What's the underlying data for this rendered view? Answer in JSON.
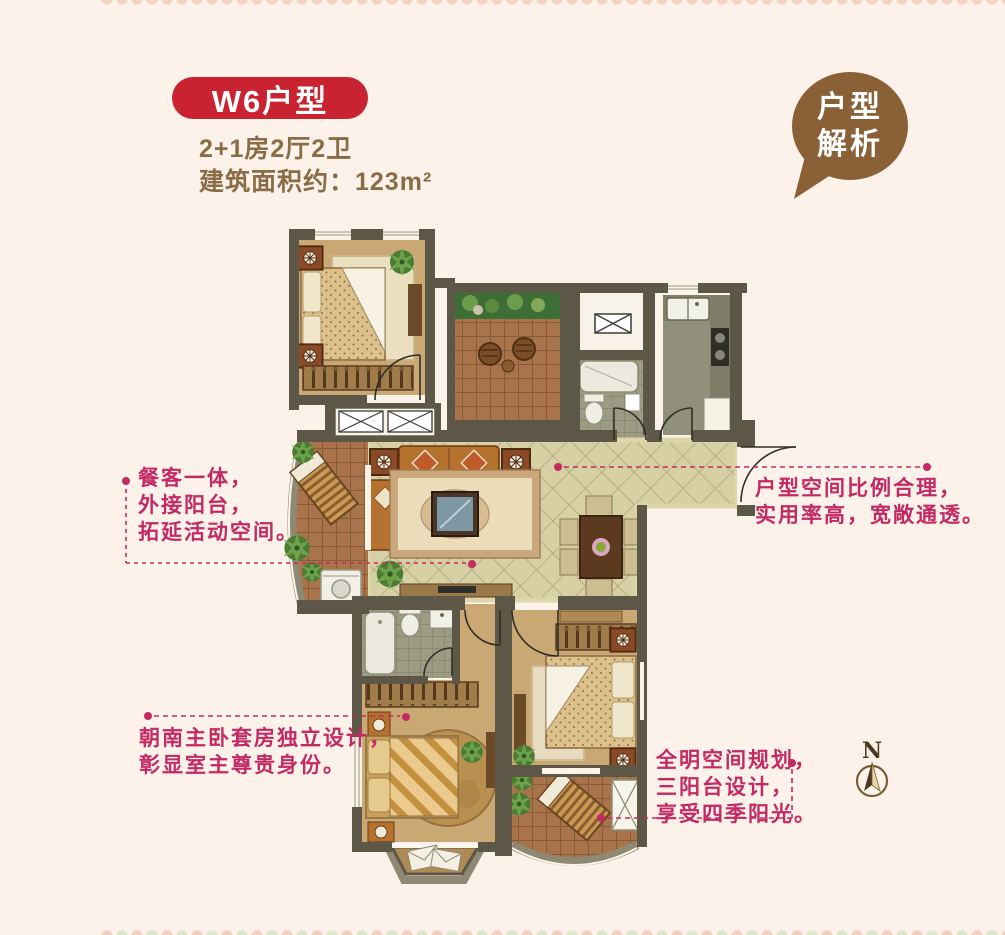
{
  "header": {
    "badge": "W6户型",
    "spec": "2+1房2厅2卫",
    "area": "建筑面积约：123m²",
    "badge_bg": "#c92230",
    "text_color": "#8a6d46"
  },
  "bubble": {
    "line1": "户型",
    "line2": "解析",
    "bg": "#8a6137"
  },
  "annotations": {
    "color": "#c32a63",
    "left": {
      "lines": [
        "餐客一体，",
        "外接阳台，",
        "拓延活动空间。"
      ]
    },
    "right": {
      "lines": [
        "户型空间比例合理，",
        "实用率高，宽敞通透。"
      ]
    },
    "bottom_left": {
      "lines": [
        "朝南主卧套房独立设计，",
        "彰显室主尊贵身份。"
      ]
    },
    "bottom_right": {
      "lines": [
        "全明空间规划，",
        "三阳台设计，",
        "享受四季阳光。"
      ]
    }
  },
  "compass": {
    "label": "N"
  },
  "floorplan_palette": {
    "wall": "#5c5746",
    "living_tile": "#d6d0a4",
    "wood_floor": "#c9a873",
    "balcony_tile": "#a9744b",
    "bath_tile": "#9c9c84",
    "planter_green": "#3c6e35",
    "leader_pink": "#c32a63"
  }
}
